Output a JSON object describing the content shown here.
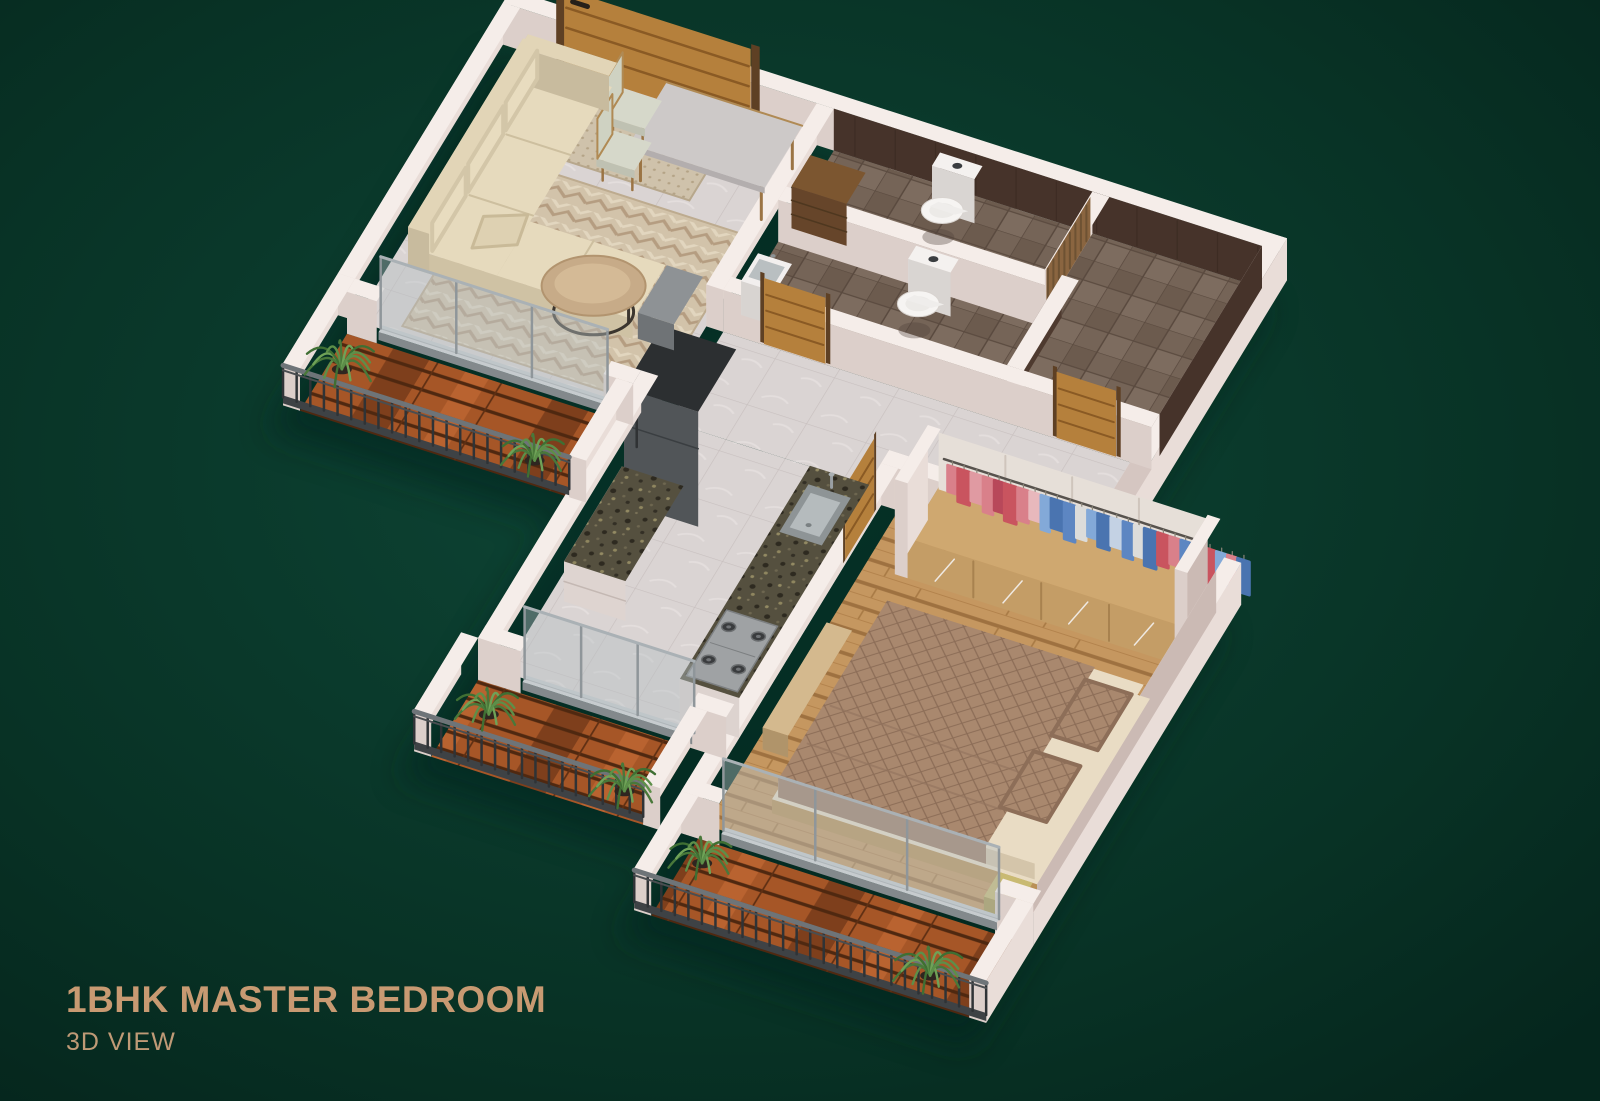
{
  "header": {
    "title": "1BHK MASTER BEDROOM",
    "subtitle": "3D VIEW"
  },
  "palette": {
    "background_center": "#0e4636",
    "background_edge": "#05261d",
    "title_text": "#c89a72",
    "subtitle_text": "#bf9a76",
    "wall_top": "#f5ede9",
    "wall_light": "#e9ddd8",
    "wall_mid": "#dccfca",
    "wall_inner_shadow": "#cbbab4",
    "marble_floor": "#dad4d3",
    "marble_line": "#c8c0bf",
    "bath_floor": "#756457",
    "bath_wall": "#46332a",
    "bedroom_wood": "#c59760",
    "balcony_wood": "#a65627",
    "rug": "#d2c3aa",
    "doormat": "#cfc2ab",
    "sofa": "#e6dabd",
    "door_wood": "#b5803c",
    "granite": "#55503f",
    "appliance_grey": "#54585b",
    "railing": "#3e4245",
    "plant_green": "#5d8f49",
    "bed_quilt": "#a9886e",
    "glass": "#b6c0c4",
    "toilet_white": "#f6f4f2",
    "clothes_pink": "#d9808a",
    "clothes_red": "#c9545f",
    "clothes_blue": "#4a74b0",
    "clothes_light_blue": "#83a9d8",
    "clothes_white": "#dcdcda"
  }
}
